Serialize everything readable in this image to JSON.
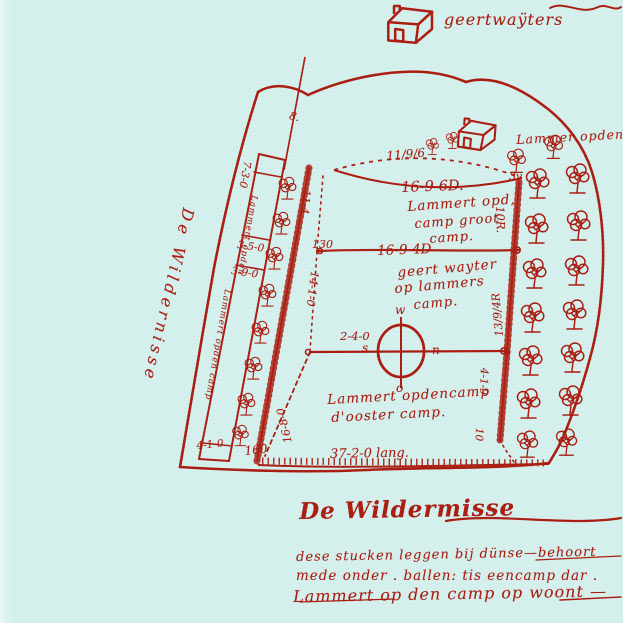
{
  "palette": {
    "ink": "#a81b10",
    "paper": "#d3efec"
  },
  "icons": {
    "tree": "deciduous-tree",
    "house": "farmhouse",
    "compass": "compass-rose"
  },
  "farms": {
    "top_label": "geertwaÿters",
    "right_label": "Lammer opdencamp"
  },
  "fields": {
    "top": {
      "edge_top": "11/9/6",
      "corner": "3v",
      "area": "16-9-6D.",
      "owner": [
        "Lammert opd,",
        "camp groot",
        "camp."
      ],
      "edge_left": "11-4",
      "edge_right": "10R."
    },
    "middle": {
      "area": "16-9-4D",
      "owner": [
        "geert wayter",
        "op lammers",
        "camp."
      ],
      "edge_left": "14-1-0",
      "edge_right": "13/9/4R"
    },
    "bottom": {
      "owner": [
        "Lammert opdencamp",
        "d'ooster camp."
      ],
      "edge_left": "16-8-0",
      "edge_mid": "2-4-0",
      "edge_right_a": "4-1-9",
      "edge_right_b": "10",
      "corner": "160",
      "edge_bottom": "37-2-0 lang."
    }
  },
  "strips": {
    "n1": "7-3-0",
    "n2": "3-5-0",
    "n3": "3-9-0",
    "n4": "4-1-0",
    "corner": "130",
    "script_a": "Lammert opden",
    "script_b": "Lammert opden camp",
    "mark": "8."
  },
  "compass": {
    "w": "w",
    "s": "s",
    "n": "n",
    "o": "o"
  },
  "wilderness": {
    "side": "De Wildernisse",
    "bottom": "De Wildermisse"
  },
  "notes": {
    "line1": "dese stucken leggen bij dünse—behoort",
    "line2": "mede onder .  ballen:  tis eencamp dar .",
    "line3": "Lammert op den camp op woont —"
  }
}
